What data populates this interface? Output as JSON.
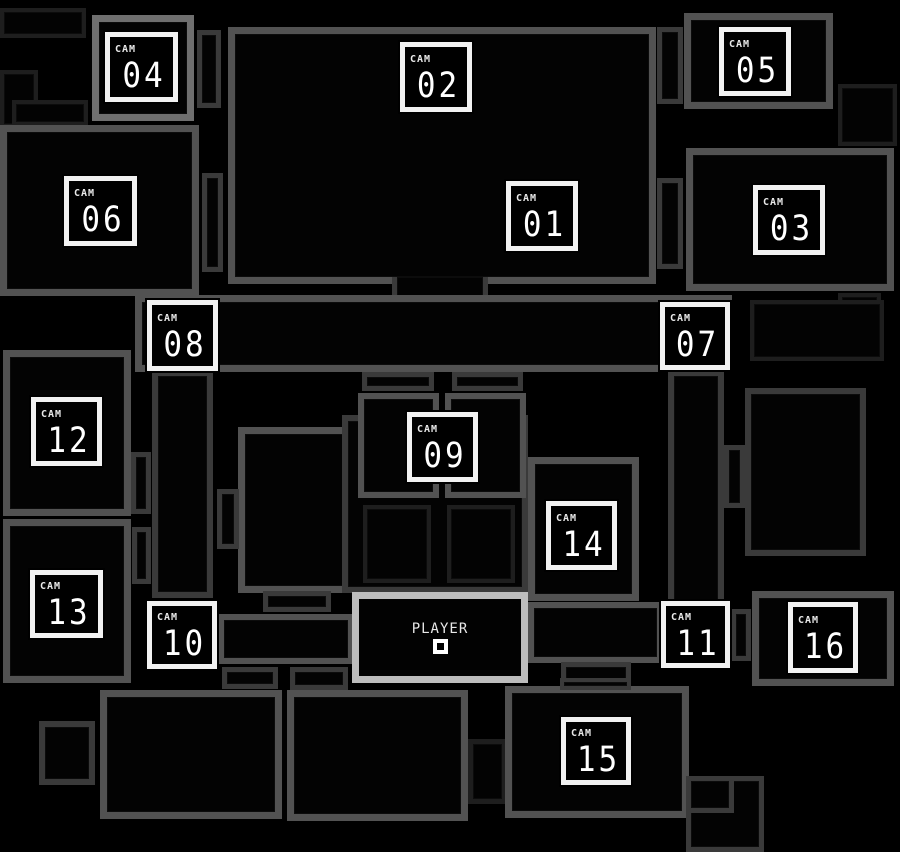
{
  "map": {
    "title": "camera-map",
    "palette": {
      "background": "#000000",
      "room_fill": "#030303",
      "wall_bright": "#6f6f6f",
      "wall_mid": "#525252",
      "wall_dim": "#3a3a3a",
      "wall_faint": "#1e1e1e",
      "wall_player": "#bdbdbd",
      "button_border": "#f2f2f2",
      "text": "#ffffff"
    },
    "rooms": [
      {
        "name": "backstage-nw-a",
        "x": 0,
        "y": 8,
        "w": 86,
        "h": 30,
        "wall": "wall_faint",
        "t": 4
      },
      {
        "name": "backstage-nw-b",
        "x": 0,
        "y": 70,
        "w": 38,
        "h": 58,
        "wall": "wall_faint",
        "t": 4
      },
      {
        "name": "backstage-nw-c",
        "x": 12,
        "y": 100,
        "w": 76,
        "h": 26,
        "wall": "wall_faint",
        "t": 4
      },
      {
        "name": "cam04-room",
        "x": 92,
        "y": 15,
        "w": 102,
        "h": 106,
        "wall": "wall_bright",
        "t": 7
      },
      {
        "name": "cam04-east-corridor",
        "x": 197,
        "y": 30,
        "w": 24,
        "h": 78,
        "wall": "wall_dim",
        "t": 5
      },
      {
        "name": "main-stage-room",
        "x": 228,
        "y": 27,
        "w": 428,
        "h": 257,
        "wall": "wall_mid",
        "t": 7
      },
      {
        "name": "stage-passage",
        "x": 392,
        "y": 277,
        "w": 96,
        "h": 27,
        "wall": "wall_dim",
        "t": 5,
        "sides": "lr"
      },
      {
        "name": "cam05-room",
        "x": 684,
        "y": 13,
        "w": 149,
        "h": 96,
        "wall": "wall_mid",
        "t": 7
      },
      {
        "name": "cam05-west-corridor",
        "x": 657,
        "y": 27,
        "w": 26,
        "h": 77,
        "wall": "wall_dim",
        "t": 5
      },
      {
        "name": "faint-room-ne",
        "x": 838,
        "y": 84,
        "w": 59,
        "h": 62,
        "wall": "wall_faint",
        "t": 4
      },
      {
        "name": "cam06-room",
        "x": 0,
        "y": 125,
        "w": 199,
        "h": 171,
        "wall": "wall_mid",
        "t": 7
      },
      {
        "name": "cam06-east-corridor",
        "x": 202,
        "y": 173,
        "w": 21,
        "h": 99,
        "wall": "wall_dim",
        "t": 5
      },
      {
        "name": "cam03-room",
        "x": 686,
        "y": 148,
        "w": 208,
        "h": 143,
        "wall": "wall_mid",
        "t": 7
      },
      {
        "name": "cam03-west-corridor",
        "x": 657,
        "y": 178,
        "w": 26,
        "h": 91,
        "wall": "wall_dim",
        "t": 5
      },
      {
        "name": "faint-room-e",
        "x": 838,
        "y": 293,
        "w": 43,
        "h": 28,
        "wall": "wall_faint",
        "t": 4
      },
      {
        "name": "main-hallway",
        "x": 135,
        "y": 295,
        "w": 597,
        "h": 77,
        "wall": "wall_mid",
        "t": 7
      },
      {
        "name": "left-corridor",
        "x": 152,
        "y": 370,
        "w": 61,
        "h": 228,
        "wall": "wall_dim",
        "t": 6
      },
      {
        "name": "right-corridor",
        "x": 668,
        "y": 370,
        "w": 56,
        "h": 236,
        "wall": "wall_dim",
        "t": 6
      },
      {
        "name": "faint-room-cam07-east",
        "x": 750,
        "y": 300,
        "w": 134,
        "h": 61,
        "wall": "wall_faint",
        "t": 4
      },
      {
        "name": "cam12-room",
        "x": 3,
        "y": 350,
        "w": 128,
        "h": 166,
        "wall": "wall_mid",
        "t": 7
      },
      {
        "name": "west-connector-a",
        "x": 131,
        "y": 452,
        "w": 20,
        "h": 62,
        "wall": "wall_dim",
        "t": 5
      },
      {
        "name": "cam13-room",
        "x": 3,
        "y": 519,
        "w": 128,
        "h": 164,
        "wall": "wall_mid",
        "t": 7
      },
      {
        "name": "west-connector-b",
        "x": 132,
        "y": 527,
        "w": 19,
        "h": 57,
        "wall": "wall_dim",
        "t": 5
      },
      {
        "name": "storage-room",
        "x": 238,
        "y": 427,
        "w": 118,
        "h": 166,
        "wall": "wall_mid",
        "t": 7
      },
      {
        "name": "storage-west-connector",
        "x": 217,
        "y": 489,
        "w": 22,
        "h": 60,
        "wall": "wall_dim",
        "t": 5
      },
      {
        "name": "storage-annex",
        "x": 263,
        "y": 591,
        "w": 68,
        "h": 21,
        "wall": "wall_dim",
        "t": 5
      },
      {
        "name": "dining-outer",
        "x": 342,
        "y": 415,
        "w": 186,
        "h": 178,
        "wall": "wall_dim",
        "t": 6
      },
      {
        "name": "party-room-a",
        "x": 358,
        "y": 393,
        "w": 81,
        "h": 105,
        "wall": "wall_mid",
        "t": 6
      },
      {
        "name": "party-room-b",
        "x": 445,
        "y": 393,
        "w": 81,
        "h": 105,
        "wall": "wall_mid",
        "t": 6
      },
      {
        "name": "table-a",
        "x": 362,
        "y": 372,
        "w": 72,
        "h": 19,
        "wall": "wall_dim",
        "t": 5
      },
      {
        "name": "table-b",
        "x": 452,
        "y": 372,
        "w": 71,
        "h": 19,
        "wall": "wall_dim",
        "t": 5
      },
      {
        "name": "table-c",
        "x": 363,
        "y": 505,
        "w": 68,
        "h": 78,
        "wall": "wall_faint",
        "t": 4
      },
      {
        "name": "table-d",
        "x": 447,
        "y": 505,
        "w": 68,
        "h": 78,
        "wall": "wall_faint",
        "t": 4
      },
      {
        "name": "cam14-room",
        "x": 528,
        "y": 457,
        "w": 111,
        "h": 144,
        "wall": "wall_mid",
        "t": 7
      },
      {
        "name": "east-room",
        "x": 745,
        "y": 388,
        "w": 121,
        "h": 168,
        "wall": "wall_dim",
        "t": 6
      },
      {
        "name": "east-room-connector",
        "x": 724,
        "y": 445,
        "w": 21,
        "h": 63,
        "wall": "wall_dim",
        "t": 5
      },
      {
        "name": "west-hall",
        "x": 218,
        "y": 614,
        "w": 136,
        "h": 50,
        "wall": "wall_mid",
        "t": 6
      },
      {
        "name": "west-hall-annex-a",
        "x": 222,
        "y": 667,
        "w": 56,
        "h": 22,
        "wall": "wall_dim",
        "t": 5
      },
      {
        "name": "west-hall-annex-b",
        "x": 290,
        "y": 667,
        "w": 58,
        "h": 23,
        "wall": "wall_dim",
        "t": 5
      },
      {
        "name": "east-hall",
        "x": 528,
        "y": 602,
        "w": 135,
        "h": 61,
        "wall": "wall_mid",
        "t": 6
      },
      {
        "name": "east-hall-annex",
        "x": 561,
        "y": 662,
        "w": 70,
        "h": 22,
        "wall": "wall_dim",
        "t": 5
      },
      {
        "name": "cam11-east-connector",
        "x": 731,
        "y": 609,
        "w": 20,
        "h": 52,
        "wall": "wall_dim",
        "t": 5
      },
      {
        "name": "cam16-room",
        "x": 752,
        "y": 591,
        "w": 142,
        "h": 95,
        "wall": "wall_mid",
        "t": 7
      },
      {
        "name": "sw-small-square",
        "x": 39,
        "y": 721,
        "w": 56,
        "h": 64,
        "wall": "wall_dim",
        "t": 6
      },
      {
        "name": "sw-room",
        "x": 100,
        "y": 690,
        "w": 182,
        "h": 129,
        "wall": "wall_mid",
        "t": 7
      },
      {
        "name": "s-room",
        "x": 287,
        "y": 690,
        "w": 181,
        "h": 131,
        "wall": "wall_mid",
        "t": 7
      },
      {
        "name": "s-connector",
        "x": 468,
        "y": 739,
        "w": 39,
        "h": 65,
        "wall": "wall_faint",
        "t": 5
      },
      {
        "name": "cam15-room",
        "x": 505,
        "y": 686,
        "w": 184,
        "h": 132,
        "wall": "wall_mid",
        "t": 7
      },
      {
        "name": "cam15-notch",
        "x": 560,
        "y": 678,
        "w": 71,
        "h": 12,
        "wall": "wall_dim",
        "t": 4
      },
      {
        "name": "se-corner-room",
        "x": 686,
        "y": 776,
        "w": 78,
        "h": 76,
        "wall": "wall_dim",
        "t": 5
      },
      {
        "name": "se-box",
        "x": 686,
        "y": 776,
        "w": 48,
        "h": 37,
        "wall": "wall_dim",
        "t": 5
      }
    ],
    "cam_label": "CAM",
    "cams": [
      {
        "id": "01",
        "number": "01",
        "x": 506,
        "y": 181,
        "w": 72,
        "h": 70
      },
      {
        "id": "02",
        "number": "02",
        "x": 400,
        "y": 42,
        "w": 72,
        "h": 70
      },
      {
        "id": "03",
        "number": "03",
        "x": 753,
        "y": 185,
        "w": 72,
        "h": 70
      },
      {
        "id": "04",
        "number": "04",
        "x": 105,
        "y": 32,
        "w": 73,
        "h": 70
      },
      {
        "id": "05",
        "number": "05",
        "x": 719,
        "y": 27,
        "w": 72,
        "h": 69
      },
      {
        "id": "06",
        "number": "06",
        "x": 64,
        "y": 176,
        "w": 73,
        "h": 70
      },
      {
        "id": "07",
        "number": "07",
        "x": 660,
        "y": 302,
        "w": 70,
        "h": 68
      },
      {
        "id": "08",
        "number": "08",
        "x": 147,
        "y": 300,
        "w": 71,
        "h": 71
      },
      {
        "id": "09",
        "number": "09",
        "x": 407,
        "y": 412,
        "w": 71,
        "h": 70
      },
      {
        "id": "10",
        "number": "10",
        "x": 147,
        "y": 601,
        "w": 70,
        "h": 68
      },
      {
        "id": "11",
        "number": "11",
        "x": 661,
        "y": 601,
        "w": 69,
        "h": 67
      },
      {
        "id": "12",
        "number": "12",
        "x": 31,
        "y": 397,
        "w": 71,
        "h": 69
      },
      {
        "id": "13",
        "number": "13",
        "x": 30,
        "y": 570,
        "w": 73,
        "h": 68
      },
      {
        "id": "14",
        "number": "14",
        "x": 546,
        "y": 501,
        "w": 71,
        "h": 69
      },
      {
        "id": "15",
        "number": "15",
        "x": 561,
        "y": 717,
        "w": 70,
        "h": 68
      },
      {
        "id": "16",
        "number": "16",
        "x": 788,
        "y": 602,
        "w": 70,
        "h": 71
      }
    ],
    "player": {
      "label": "PLAYER",
      "room": {
        "x": 352,
        "y": 592,
        "w": 176,
        "h": 91
      },
      "wall": "wall_player",
      "marker": "square"
    }
  }
}
